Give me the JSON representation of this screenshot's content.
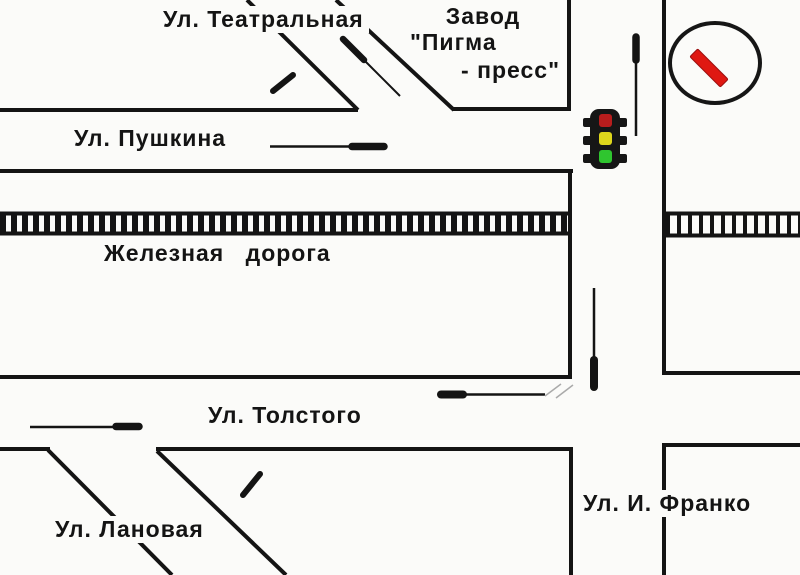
{
  "map": {
    "streets": {
      "theatralnaya": "Ул. Театральная",
      "pushkina": "Ул. Пушкина",
      "tolstogo": "Ул. Толстого",
      "lanovaya": "Ул. Лановая",
      "franko": "Ул. И. Франко"
    },
    "railway_label": "Железная дорога",
    "factory": {
      "line1": "Завод",
      "line2": "\"Пигма",
      "line3": "- пресс\""
    }
  },
  "traffic_light": {
    "red": "#b81d1d",
    "yellow": "#ded61c",
    "green": "#2fc52f",
    "body": "#161616"
  },
  "sign": {
    "shape": "circle-with-red-diagonal-bar",
    "bar_color": "#df1812",
    "border_color": "#161616"
  },
  "colors": {
    "line": "#141414",
    "background": "#fbfbf9",
    "scribble": "#aaaaaa"
  }
}
